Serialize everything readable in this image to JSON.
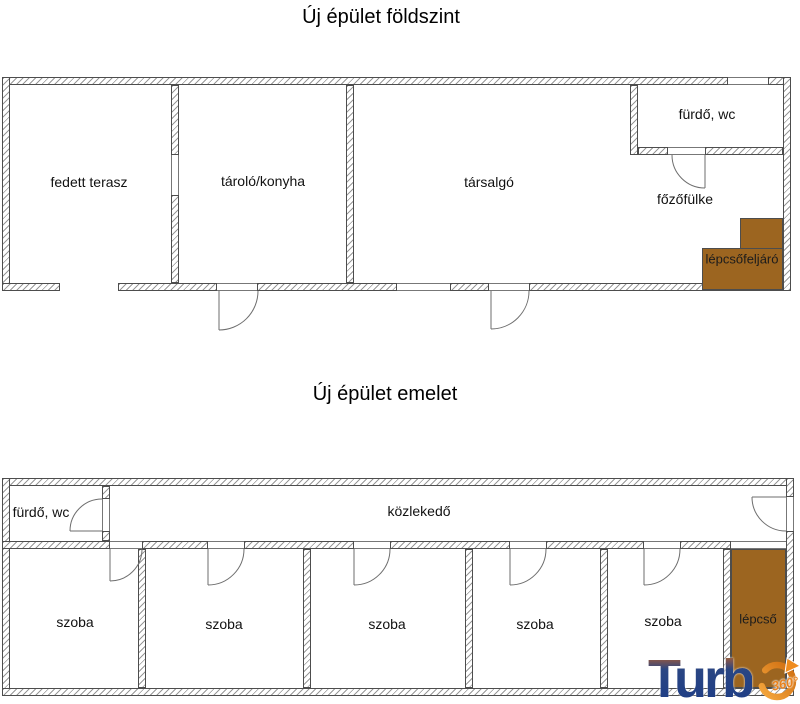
{
  "plan_ground": {
    "title": "Új épület földszint",
    "rooms": [
      {
        "label": "fedett terasz"
      },
      {
        "label": "tároló/konyha"
      },
      {
        "label": "társalgó"
      },
      {
        "label": "fürdő, wc"
      },
      {
        "label": "főzőfülke"
      },
      {
        "label": "lépcsőfeljáró"
      }
    ]
  },
  "plan_upper": {
    "title": "Új épület emelet",
    "rooms": [
      {
        "label": "fürdő, wc"
      },
      {
        "label": "közlekedő"
      },
      {
        "label": "szoba"
      },
      {
        "label": "szoba"
      },
      {
        "label": "szoba"
      },
      {
        "label": "szoba"
      },
      {
        "label": "szoba"
      },
      {
        "label": "lépcső"
      }
    ]
  },
  "logo": {
    "wordmark": "Turb",
    "badge_text": "360°"
  },
  "colors": {
    "stairs_fill": "#9c6520",
    "logo_blue": "#1d3c86",
    "logo_orange": "#e8821e",
    "wall_line": "#4d4d4d"
  }
}
